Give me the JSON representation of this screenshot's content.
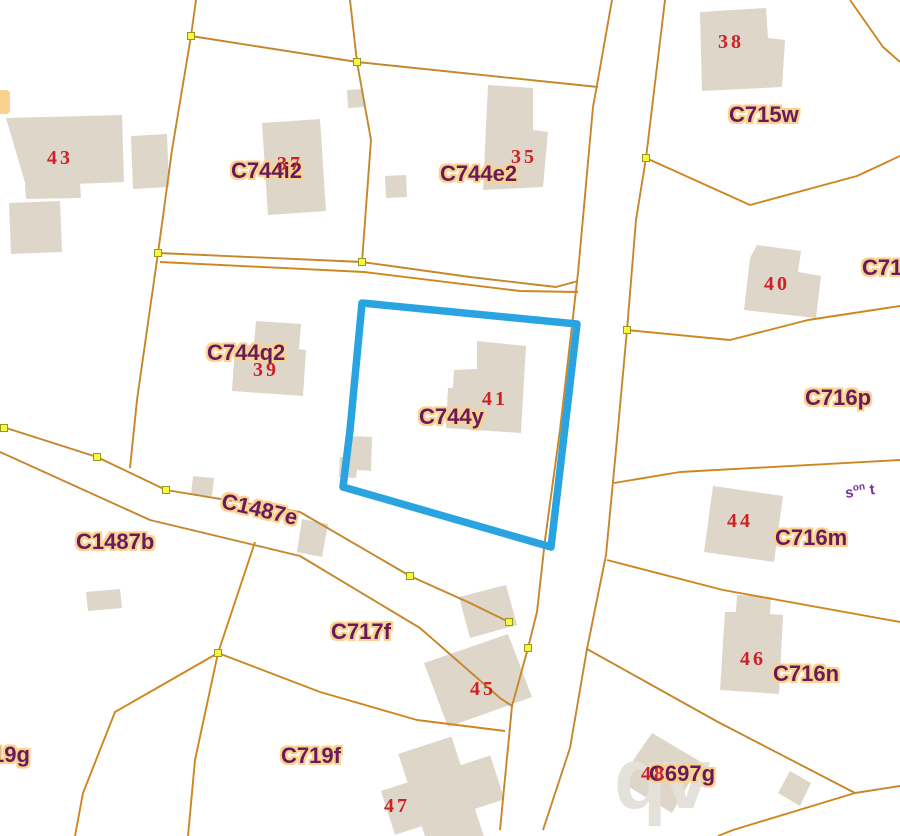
{
  "map": {
    "type": "cadastral-parcel-map",
    "selected_parcel": "C744y"
  },
  "labels": {
    "c744i2": "C744i2",
    "c744e2": "C744e2",
    "c715w": "C715w",
    "c71_cut": "C71",
    "c744q2": "C744q2",
    "c744y": "C744y",
    "c716p": "C716p",
    "c1487e": "C1487e",
    "c1487b": "C1487b",
    "c716m": "C716m",
    "c717f": "C717f",
    "c716n": "C716n",
    "c719f": "C719f",
    "c697g": "C697g",
    "c719g_cut": "19g"
  },
  "house_numbers": {
    "n35": "35",
    "n37": "37",
    "n38": "38",
    "n39": "39",
    "n40": "40",
    "n41": "41",
    "n43": "43",
    "n44": "44",
    "n45": "45",
    "n46": "46",
    "n47": "47",
    "n48": "48"
  },
  "street_label": {
    "s": "s",
    "sup": "on",
    "t": "t"
  },
  "watermark": "qv",
  "colors": {
    "selected_outline": "#29a4e1",
    "boundary_line": "#cf861f",
    "parcel_label": "#681b5c",
    "label_halo": "#f8d28e",
    "house_number": "#cd2127",
    "building_fill": "#ded6c9",
    "vertex_fill": "#f4f93e",
    "vertex_border": "#97971f",
    "watermark_color": "#e4e1db",
    "background": "#ffffff"
  }
}
